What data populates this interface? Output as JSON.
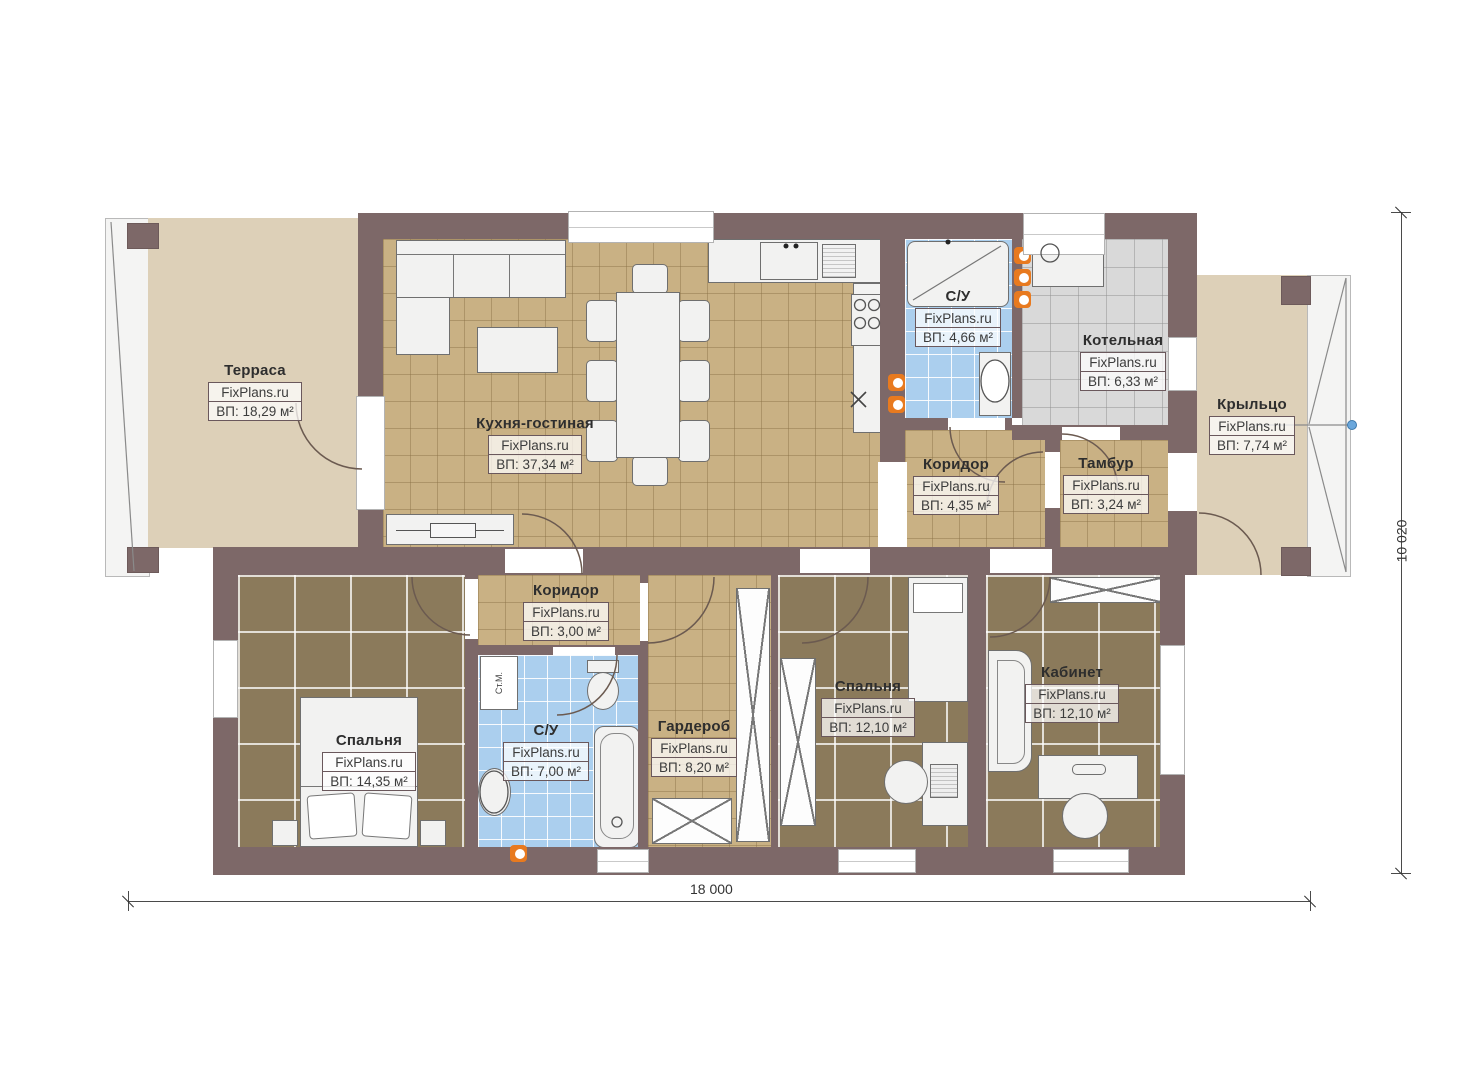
{
  "watermark": "FixPlans.ru",
  "rooms": [
    {
      "id": "terrace",
      "name": "Терраса",
      "area": "ВП: 18,29 м²"
    },
    {
      "id": "kitchen-living",
      "name": "Кухня-гостиная",
      "area": "ВП: 37,34 м²"
    },
    {
      "id": "bathroom-upper",
      "name": "С/У",
      "area": "ВП: 4,66 м²"
    },
    {
      "id": "boiler-room",
      "name": "Котельная",
      "area": "ВП: 6,33 м²"
    },
    {
      "id": "corridor-upper",
      "name": "Коридор",
      "area": "ВП: 4,35 м²"
    },
    {
      "id": "vestibule",
      "name": "Тамбур",
      "area": "ВП: 3,24 м²"
    },
    {
      "id": "porch",
      "name": "Крыльцо",
      "area": "ВП: 7,74 м²"
    },
    {
      "id": "corridor-lower",
      "name": "Коридор",
      "area": "ВП: 3,00 м²"
    },
    {
      "id": "bedroom-1",
      "name": "Спальня",
      "area": "ВП: 14,35 м²"
    },
    {
      "id": "bathroom-lower",
      "name": "С/У",
      "area": "ВП: 7,00 м²"
    },
    {
      "id": "wardrobe",
      "name": "Гардероб",
      "area": "ВП: 8,20 м²"
    },
    {
      "id": "bedroom-2",
      "name": "Спальня",
      "area": "ВП: 12,10 м²"
    },
    {
      "id": "office",
      "name": "Кабинет",
      "area": "ВП: 12,10 м²"
    }
  ],
  "dimensions": {
    "width_label": "18 000",
    "height_label": "10 020"
  },
  "fixtures": {
    "washing_machine_label": "Ст.М."
  },
  "colors": {
    "wall": "#7d6868",
    "kitchen_floor": "#c9b184",
    "bedroom_floor": "#8b7a5b",
    "bath_floor": "#abcfee",
    "boiler_floor": "#d9d9d9",
    "terrace_floor": "#ddd0b8",
    "radiator": "#e87a1f",
    "porch_marker": "#6aa7dc"
  }
}
